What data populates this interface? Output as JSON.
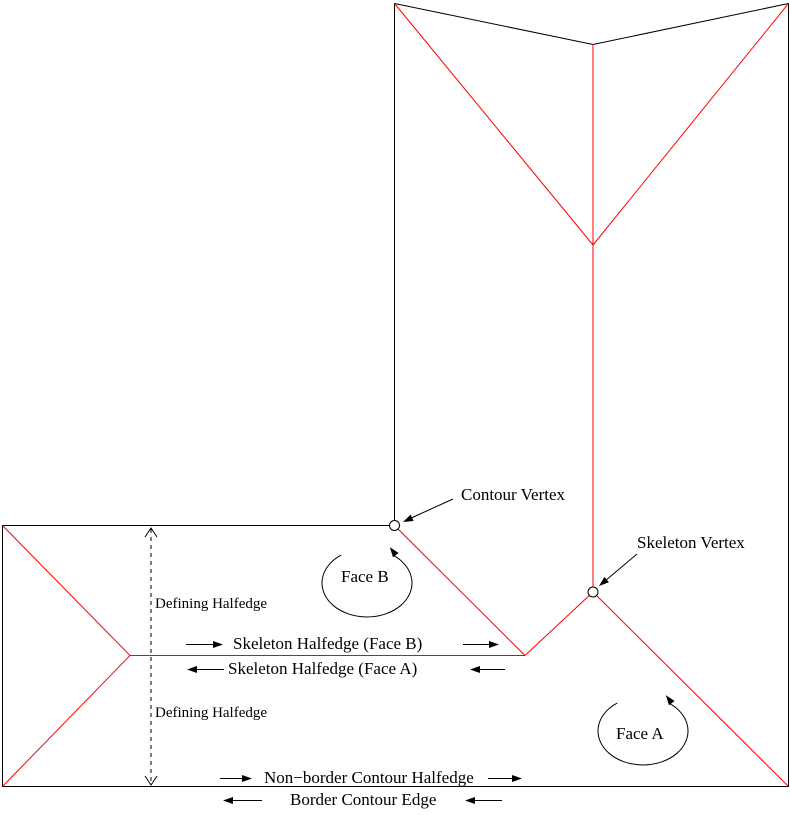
{
  "figure": {
    "labels": {
      "contour_vertex": "Contour Vertex",
      "skeleton_vertex": "Skeleton Vertex",
      "face_b": "Face B",
      "face_a": "Face A",
      "defining_halfedge_top": "Defining Halfedge",
      "defining_halfedge_bottom": "Defining Halfedge",
      "skeleton_halfedge_face_b": "Skeleton Halfedge (Face B)",
      "skeleton_halfedge_face_a": "Skeleton Halfedge (Face A)",
      "non_border_contour_halfedge": "Non−border Contour Halfedge",
      "border_contour_edge": "Border Contour Edge"
    },
    "colors": {
      "contour": "#000000",
      "skeleton": "#ff0000",
      "text": "#000000",
      "background": "#ffffff"
    },
    "icons": {
      "right_arrow": "→",
      "left_arrow": "←",
      "up_arrow": "↑",
      "down_arrow": "↓"
    }
  }
}
